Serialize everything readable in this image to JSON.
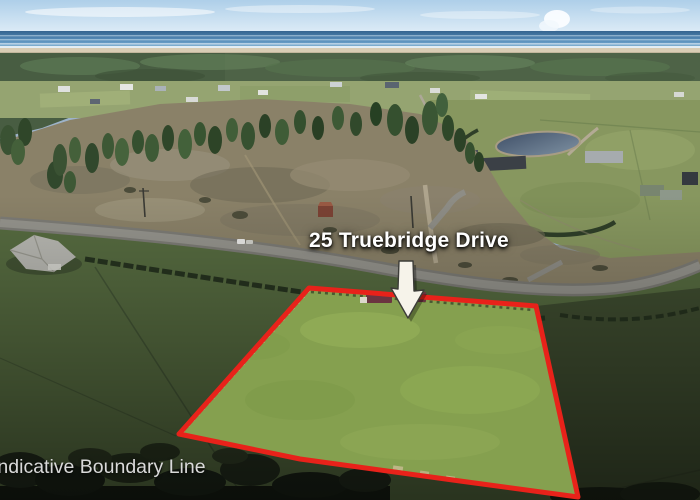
{
  "overlay": {
    "property_label": "25 Truebridge Drive",
    "disclaimer_label": "Indicative Boundary Line",
    "arrow_icon": "down-arrow-icon",
    "colors": {
      "boundary_line": "#e8221a",
      "property_label_text": "#ffffff",
      "disclaimer_text": "#d9d9d9",
      "arrow_fill": "#f6f3ea"
    }
  }
}
